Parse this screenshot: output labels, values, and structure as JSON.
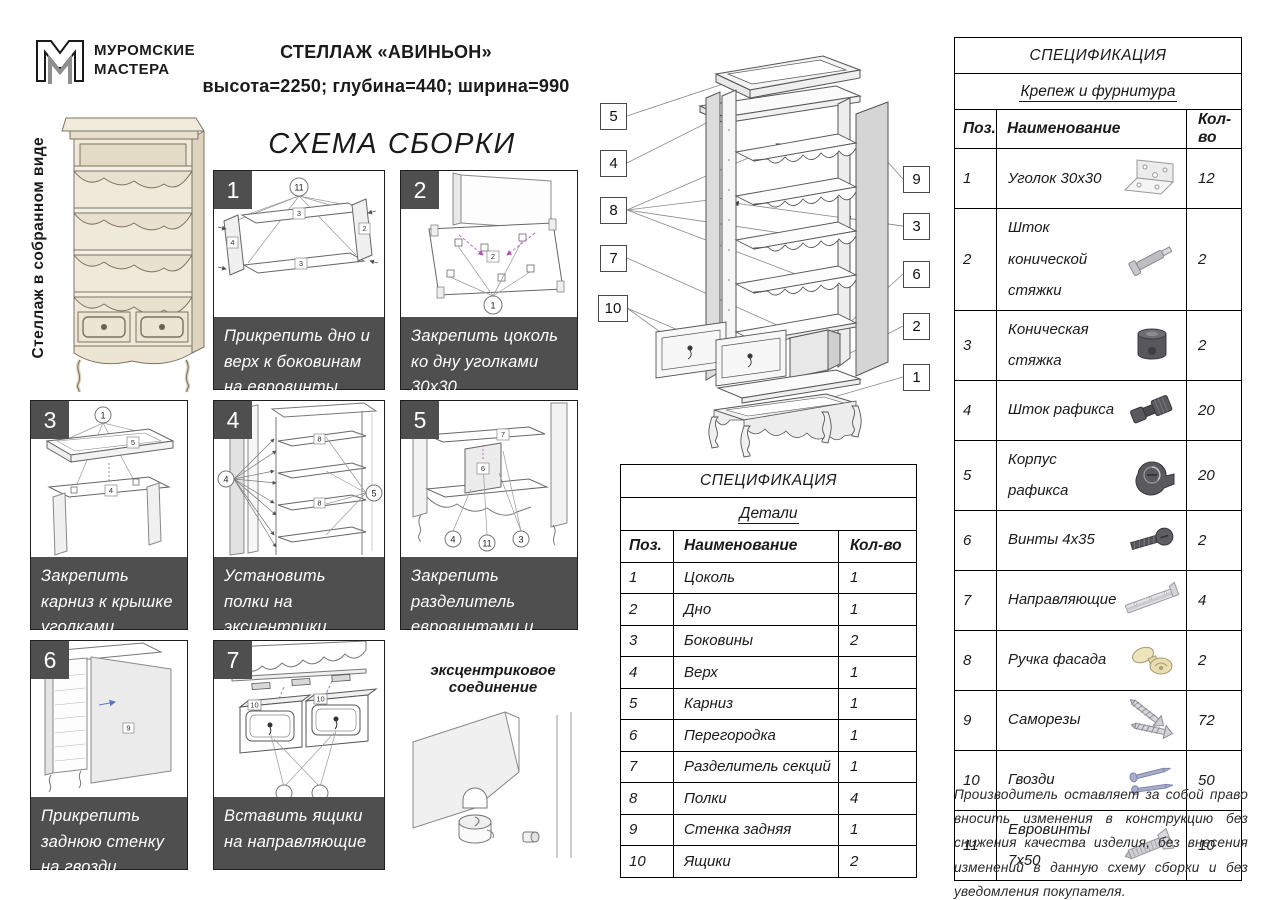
{
  "page": {
    "brand_line1": "МУРОМСКИЕ",
    "brand_line2": "МАСТЕРА",
    "title": "СТЕЛЛАЖ «АВИНЬОН»",
    "dimensions": "высота=2250; глубина=440; ширина=990",
    "scheme_title": "СХЕМА СБОРКИ",
    "assembled_label": "Стеллаж в собранном виде",
    "eccentric_label": "эксцентриковое соединение",
    "disclaimer": "Производитель оставляет за собой право вносить изменения в конструкцию без снижения качества изделия, без внесения изменений в данную схему сборки и без уведомления покупателя."
  },
  "colors": {
    "band": "#4f4f50",
    "cream": "#ece5d4",
    "magenta": "#c060c0",
    "blue": "#5a78c0"
  },
  "steps": [
    {
      "num": "1",
      "caption": "Прикрепить дно и верх к боковинам на евровинты",
      "refs": [
        "11"
      ],
      "labels": [
        "3",
        "4",
        "2",
        "3"
      ]
    },
    {
      "num": "2",
      "caption": "Закрепить цоколь ко дну уголками 30х30",
      "refs": [
        "1"
      ],
      "labels": [
        "2"
      ]
    },
    {
      "num": "3",
      "caption": "Закрепить карниз к крышке уголками",
      "refs": [
        "1"
      ],
      "labels": [
        "5",
        "4"
      ]
    },
    {
      "num": "4",
      "caption": "Установить полки  на эксцентрики «рафикс»",
      "refs": [
        "4",
        "5"
      ],
      "labels": [
        "8",
        "8"
      ]
    },
    {
      "num": "5",
      "caption": "Закрепить разделитель евровинтами и стяжкой",
      "refs": [
        "4",
        "11",
        "3"
      ],
      "labels": [
        "7",
        "6"
      ]
    },
    {
      "num": "6",
      "caption": "Прикрепить заднюю стенку на гвозди",
      "refs": [],
      "labels": [
        "9"
      ]
    },
    {
      "num": "7",
      "caption": "Вставить ящики на направляющие",
      "refs": [],
      "labels": [
        "10",
        "10"
      ]
    }
  ],
  "exploded": {
    "callouts": [
      "5",
      "4",
      "8",
      "7",
      "10",
      "9",
      "3",
      "6",
      "2",
      "1"
    ]
  },
  "parts_table": {
    "title": "СПЕЦИФИКАЦИЯ",
    "subtitle": "Детали",
    "headers": [
      "Поз.",
      "Наименование",
      "Кол-во"
    ],
    "rows": [
      {
        "pos": "1",
        "name": "Цоколь",
        "qty": "1"
      },
      {
        "pos": "2",
        "name": "Дно",
        "qty": "1"
      },
      {
        "pos": "3",
        "name": "Боковины",
        "qty": "2"
      },
      {
        "pos": "4",
        "name": "Верх",
        "qty": "1"
      },
      {
        "pos": "5",
        "name": "Карниз",
        "qty": "1"
      },
      {
        "pos": "6",
        "name": "Перегородка",
        "qty": "1"
      },
      {
        "pos": "7",
        "name": "Разделитель секций",
        "qty": "1"
      },
      {
        "pos": "8",
        "name": "Полки",
        "qty": "4"
      },
      {
        "pos": "9",
        "name": "Стенка задняя",
        "qty": "1"
      },
      {
        "pos": "10",
        "name": "Ящики",
        "qty": "2"
      }
    ]
  },
  "hardware_table": {
    "title": "СПЕЦИФИКАЦИЯ",
    "subtitle": "Крепеж и фурнитура",
    "headers": [
      "Поз.",
      "Наименование",
      "Кол-во"
    ],
    "rows": [
      {
        "pos": "1",
        "name": "Уголок 30х30",
        "qty": "12",
        "icon": "angle-bracket"
      },
      {
        "pos": "2",
        "name": "Шток конической стяжки",
        "qty": "2",
        "icon": "conical-bolt-rod"
      },
      {
        "pos": "3",
        "name": "Коническая стяжка",
        "qty": "2",
        "icon": "conical-nut"
      },
      {
        "pos": "4",
        "name": "Шток рафикса",
        "qty": "20",
        "icon": "rafix-rod"
      },
      {
        "pos": "5",
        "name": "Корпус рафикса",
        "qty": "20",
        "icon": "rafix-cam"
      },
      {
        "pos": "6",
        "name": "Винты 4х35",
        "qty": "2",
        "icon": "screw"
      },
      {
        "pos": "7",
        "name": "Направляющие",
        "qty": "4",
        "icon": "drawer-slide"
      },
      {
        "pos": "8",
        "name": "Ручка фасада",
        "qty": "2",
        "icon": "handle"
      },
      {
        "pos": "9",
        "name": "Саморезы",
        "qty": "72",
        "icon": "self-tapping-screws"
      },
      {
        "pos": "10",
        "name": "Гвозди",
        "qty": "50",
        "icon": "nails"
      },
      {
        "pos": "11",
        "name": "Евровинты 7х50",
        "qty": "10",
        "icon": "euro-screw"
      }
    ]
  }
}
